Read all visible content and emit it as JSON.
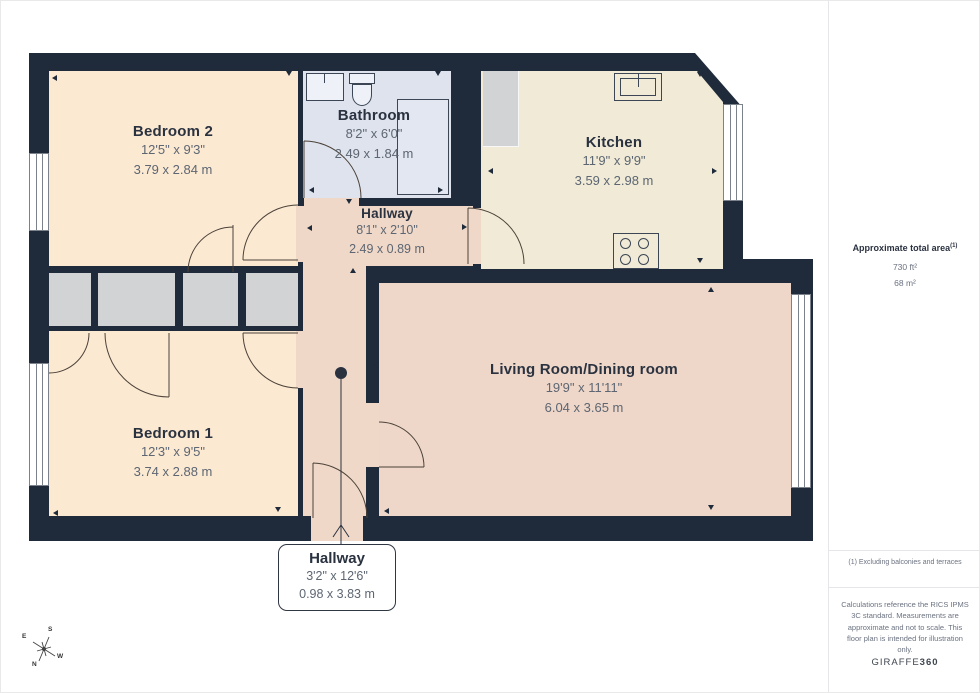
{
  "floorplan": {
    "rooms": {
      "bedroom2": {
        "name": "Bedroom 2",
        "imperial": "12'5\" x 9'3\"",
        "metric": "3.79 x 2.84 m"
      },
      "bathroom": {
        "name": "Bathroom",
        "imperial": "8'2\" x 6'0\"",
        "metric": "2.49 x 1.84 m"
      },
      "kitchen": {
        "name": "Kitchen",
        "imperial": "11'9\" x 9'9\"",
        "metric": "3.59 x 2.98 m"
      },
      "hallway": {
        "name": "Hallway",
        "imperial": "8'1\" x 2'10\"",
        "metric": "2.49 x 0.89 m"
      },
      "bedroom1": {
        "name": "Bedroom 1",
        "imperial": "12'3\" x 9'5\"",
        "metric": "3.74 x 2.88 m"
      },
      "living": {
        "name": "Living Room/Dining room",
        "imperial": "19'9\" x 11'11\"",
        "metric": "6.04 x 3.65 m"
      },
      "hallway_entry": {
        "name": "Hallway",
        "imperial": "3'2\" x 12'6\"",
        "metric": "0.98 x 3.83 m"
      }
    },
    "compass": {
      "n": "N",
      "s": "S",
      "e": "E",
      "w": "W"
    },
    "colors": {
      "wall": "#1f2b3a",
      "bedroom": "#fce9d2",
      "bathroom": "#dfe3ee",
      "kitchen": "#f0ead6",
      "living": "#eed6c8",
      "hallway": "#f0d8c8",
      "closet": "#d2d3d5"
    }
  },
  "sidebar": {
    "area_title": "Approximate total area",
    "area_footnote_marker": "(1)",
    "area_ft": "730 ft²",
    "area_m": "68 m²",
    "footnote": "(1) Excluding balconies and terraces",
    "disclaimer": "Calculations reference the RICS IPMS 3C standard. Measurements are approximate and not to scale. This floor plan is intended for illustration only.",
    "brand": "GIRAFFE",
    "brand_bold": "360"
  }
}
